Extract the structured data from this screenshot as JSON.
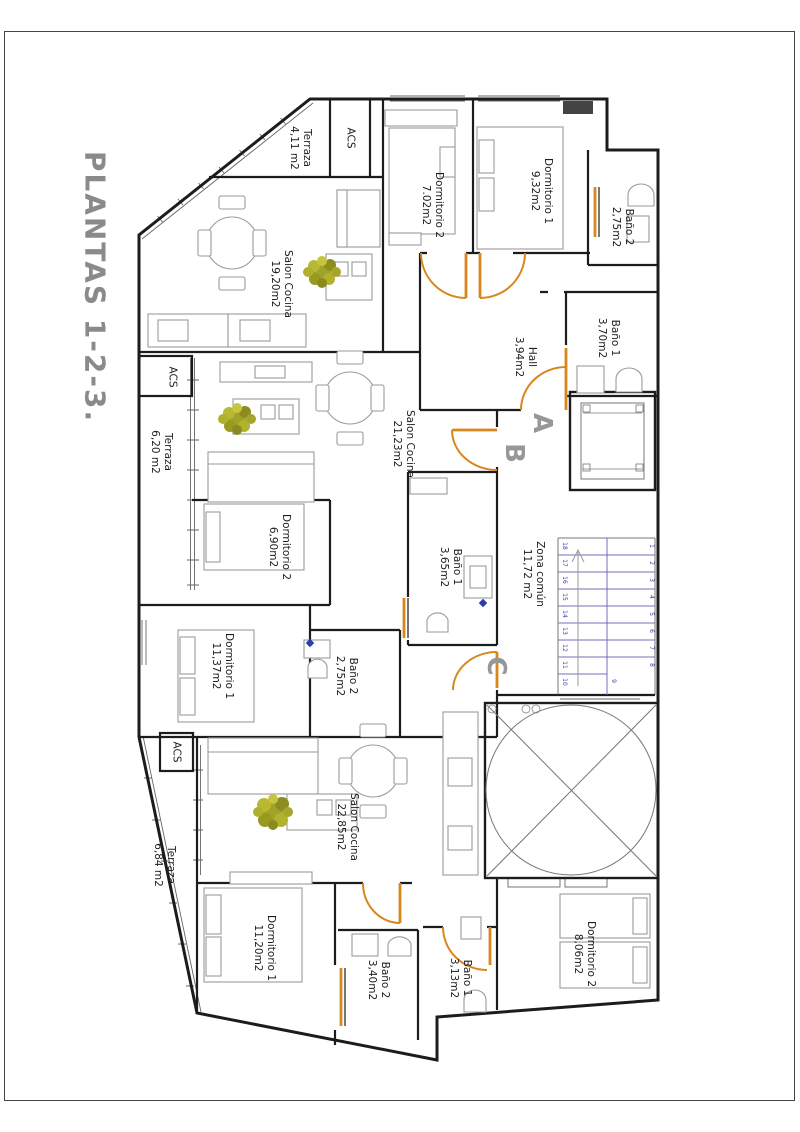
{
  "title": "PLANTAS 1-2-3.",
  "plan": {
    "apartment_a": {
      "letter": "A",
      "terraza": {
        "name": "Terraza",
        "area": "4,11 m2"
      },
      "acs": "ACS",
      "salon": {
        "name": "Salon Cocina",
        "area": "19,20m2"
      },
      "dormitorio2": {
        "name": "Dormitorio 2",
        "area": "7.02m2"
      },
      "dormitorio1": {
        "name": "Dormitorio 1",
        "area": "9,32m2"
      },
      "bano2": {
        "name": "Baño 2",
        "area": "2,75m2"
      },
      "bano1": {
        "name": "Baño 1",
        "area": "3,70m2"
      },
      "hall": {
        "name": "Hall",
        "area": "3,94m2"
      }
    },
    "apartment_b": {
      "letter": "B",
      "terraza": {
        "name": "Terraza",
        "area": "6,20 m2"
      },
      "acs": "ACS",
      "salon": {
        "name": "Salon Cocina",
        "area": "21,23m2"
      },
      "dormitorio2": {
        "name": "Dormitorio 2",
        "area": "6,90m2"
      },
      "dormitorio1": {
        "name": "Dormitorio 1",
        "area": "11,37m2"
      },
      "bano1": {
        "name": "Baño 1",
        "area": "3,65m2"
      },
      "bano2": {
        "name": "Baño 2",
        "area": "2,75m2"
      }
    },
    "apartment_c": {
      "letter": "C",
      "terraza": {
        "name": "Terraza",
        "area": "6,84 m2"
      },
      "acs": "ACS",
      "salon": {
        "name": "Salon Cocina",
        "area": "22,85m2"
      },
      "dormitorio1": {
        "name": "Dormitorio 1",
        "area": "11,20m2"
      },
      "dormitorio2": {
        "name": "Dormitorio 2",
        "area": "8,06m2"
      },
      "bano2": {
        "name": "Baño 2",
        "area": "3,40m2"
      },
      "bano1": {
        "name": "Baño 1",
        "area": "3,13m2"
      }
    },
    "common": {
      "zona_comun": {
        "name": "Zona común",
        "area": "11,72 m2"
      },
      "stairs": {
        "left": [
          "18",
          "17",
          "16",
          "15",
          "14",
          "13",
          "12",
          "11",
          "10"
        ],
        "right": [
          "1",
          "2",
          "3",
          "4",
          "5",
          "6",
          "7",
          "8"
        ],
        "landing": "9"
      }
    },
    "colors": {
      "door_accent": "#d9861c",
      "stair_lines": "#7070b8",
      "stair_numbers": "#3b3bb2",
      "letters_gray": "#979797",
      "title_gray": "#8a8a8a",
      "plant_green": "#a5a52a"
    }
  }
}
